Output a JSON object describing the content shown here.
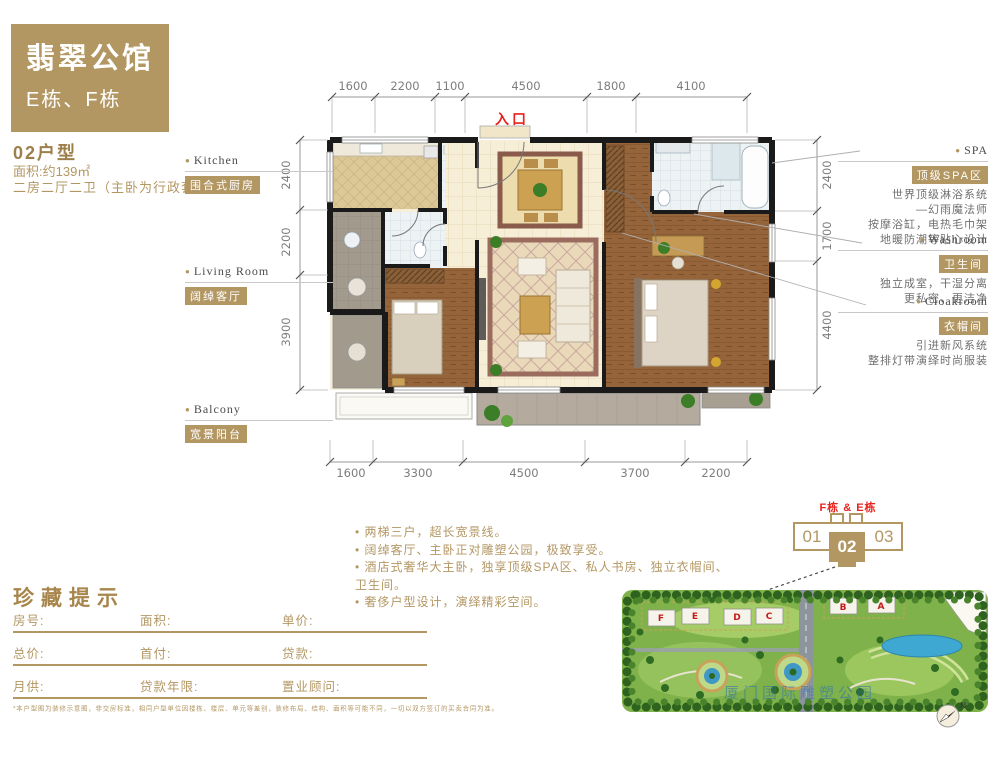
{
  "colors": {
    "gold": "#b39763",
    "red": "#e8211d"
  },
  "brand": {
    "title": "翡翠公馆",
    "subtitle": "E栋、F栋"
  },
  "unit": {
    "name": "02户型",
    "area": "面积:约139㎡",
    "rooms": "二房二厅二卫（主卧为行政套房）"
  },
  "plan": {
    "entrance": "入口",
    "dims_top": [
      "1600",
      "2200",
      "1100",
      "4500",
      "1800",
      "4100"
    ],
    "dims_bottom": [
      "1600",
      "3300",
      "4500",
      "3700",
      "2200"
    ],
    "dims_left": [
      "2400",
      "2200",
      "3900"
    ],
    "dims_right": [
      "2400",
      "1700",
      "4400"
    ]
  },
  "callouts": {
    "kitchen": {
      "en": "Kitchen",
      "tag": "围合式厨房"
    },
    "living": {
      "en": "Living Room",
      "tag": "阔绰客厅"
    },
    "balcony": {
      "en": "Balcony",
      "tag": "宽景阳台"
    },
    "spa": {
      "en": "SPA",
      "tag": "顶级SPA区",
      "lines": [
        "世界顶级淋浴系统",
        "—幻雨魔法师",
        "按摩浴缸，电热毛巾架",
        "地暖防潮等贴心设计"
      ]
    },
    "washroom": {
      "en": "Washroom",
      "tag": "卫生间",
      "lines": [
        "独立成室，干湿分离",
        "更私密、更洁净"
      ]
    },
    "cloakroom": {
      "en": "Cloakroom",
      "tag": "衣帽间",
      "lines": [
        "引进新风系统",
        "整排灯带演绎时尚服装"
      ]
    }
  },
  "selling_points": [
    "两梯三户，超长宽景线。",
    "阔绰客厅、主卧正对雕塑公园，极致享受。",
    "酒店式奢华大主卧，独享顶级SPA区、私人书房、独立衣帽间、卫生间。",
    "奢侈户型设计，演绎精彩空间。"
  ],
  "form": {
    "heading": "珍藏提示",
    "rows": [
      [
        "房号:",
        "面积:",
        "单价:"
      ],
      [
        "总价:",
        "首付:",
        "贷款:"
      ],
      [
        "月供:",
        "贷款年限:",
        "置业顾问:"
      ]
    ],
    "disclaimer": "*本户型图为装修示意图，非交房标准，相同户型单位因楼栋、楼层、单元等差别，装修布局、结构、面积等可能不同，一切以双方签订的买卖合同为准。"
  },
  "building_key": {
    "label": "F栋 & E栋",
    "left": "01",
    "center": "02",
    "right": "03"
  },
  "site_plan": {
    "watermark": "厦门国际雕塑公园",
    "buildings": [
      "F",
      "E",
      "D",
      "C",
      "B",
      "A"
    ],
    "compass": "N"
  }
}
